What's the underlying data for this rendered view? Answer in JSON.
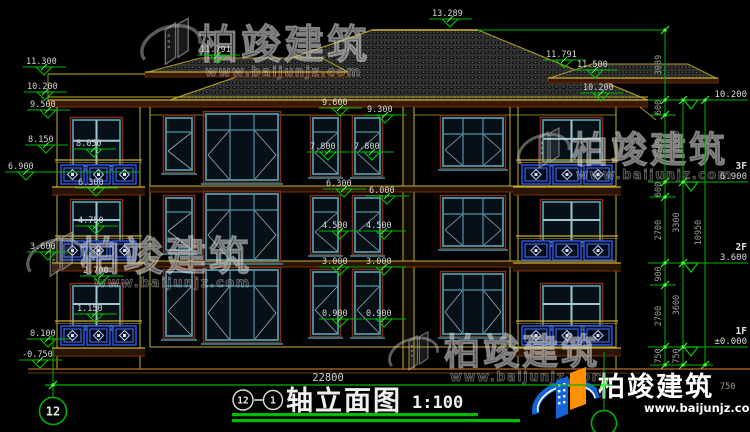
{
  "colors": {
    "dim_green": "#00b400",
    "tick_green": "#3fff3f",
    "marker_text": "#d6d6d6",
    "chain_text": "#93a389",
    "wall_yellow": "#c8b030",
    "fascia_brown": "#3a1a06",
    "fascia_edge": "#7a3010",
    "window_teal": "#4f96aa",
    "railing_blue": "#2a52e0",
    "ground_brown": "#9a5a20",
    "logo_blue": "#1565d8",
    "logo_orange": "#ff9100"
  },
  "watermark": {
    "brand": "柏竣建筑",
    "url": "www.baijunjz.com"
  },
  "title_block": {
    "axis_a": "12",
    "axis_b": "1",
    "dash": "—",
    "title": "轴立面图",
    "scale": "1:100"
  },
  "bottom": {
    "total_width": "22800",
    "axis_bubble": "12",
    "extra_750": "750"
  },
  "floor_levels": [
    {
      "label": "",
      "value": "10.200",
      "y": 100
    },
    {
      "label": "3F",
      "value": "6.900",
      "y": 182
    },
    {
      "label": "2F",
      "value": "3.600",
      "y": 263
    },
    {
      "label": "1F",
      "value": "±0.000",
      "y": 347
    }
  ],
  "dim_chains": [
    {
      "x": 665,
      "segments": [
        {
          "label": "3089",
          "y1": 30,
          "y2": 100
        },
        {
          "label": "600",
          "y1": 100,
          "y2": 115
        },
        {
          "label": "2700",
          "y1": 115,
          "y2": 182
        },
        {
          "label": "600",
          "y1": 182,
          "y2": 197
        },
        {
          "label": "2700",
          "y1": 197,
          "y2": 263
        },
        {
          "label": "900",
          "y1": 263,
          "y2": 285
        },
        {
          "label": "2700",
          "y1": 285,
          "y2": 347
        },
        {
          "label": "750",
          "y1": 347,
          "y2": 365
        }
      ]
    },
    {
      "x": 683,
      "segments": [
        {
          "label": "3300",
          "y1": 100,
          "y2": 182
        },
        {
          "label": "3300",
          "y1": 182,
          "y2": 263
        },
        {
          "label": "3600",
          "y1": 263,
          "y2": 347
        },
        {
          "label": "750",
          "y1": 347,
          "y2": 365
        }
      ]
    },
    {
      "x": 705,
      "segments": [
        {
          "label": "10950",
          "y1": 100,
          "y2": 365
        }
      ]
    }
  ],
  "elevation_markers": [
    {
      "v": "13.289",
      "x": 432,
      "y": 16
    },
    {
      "v": "11.791",
      "x": 200,
      "y": 52
    },
    {
      "v": "11.300",
      "x": 26,
      "y": 64
    },
    {
      "v": "11.791",
      "x": 546,
      "y": 57
    },
    {
      "v": "11.500",
      "x": 577,
      "y": 67
    },
    {
      "v": "10.200",
      "x": 27,
      "y": 89
    },
    {
      "v": "10.200",
      "x": 583,
      "y": 90
    },
    {
      "v": "9.500",
      "x": 30,
      "y": 107
    },
    {
      "v": "9.600",
      "x": 322,
      "y": 105
    },
    {
      "v": "9.300",
      "x": 367,
      "y": 112
    },
    {
      "v": "8.150",
      "x": 28,
      "y": 142
    },
    {
      "v": "8.050",
      "x": 76,
      "y": 146
    },
    {
      "v": "7.800",
      "x": 310,
      "y": 149
    },
    {
      "v": "7.800",
      "x": 354,
      "y": 149
    },
    {
      "v": "6.900",
      "x": 8,
      "y": 169,
      "leader": 140
    },
    {
      "v": "6.300",
      "x": 78,
      "y": 185
    },
    {
      "v": "6.300",
      "x": 326,
      "y": 186
    },
    {
      "v": "6.000",
      "x": 369,
      "y": 193
    },
    {
      "v": "4.750",
      "x": 78,
      "y": 223
    },
    {
      "v": "4.500",
      "x": 322,
      "y": 228
    },
    {
      "v": "4.500",
      "x": 366,
      "y": 228
    },
    {
      "v": "3.600",
      "x": 30,
      "y": 249
    },
    {
      "v": "3.000",
      "x": 322,
      "y": 264
    },
    {
      "v": "3.000",
      "x": 366,
      "y": 264
    },
    {
      "v": "2.700",
      "x": 83,
      "y": 273
    },
    {
      "v": "1.150",
      "x": 77,
      "y": 311
    },
    {
      "v": "0.900",
      "x": 322,
      "y": 316
    },
    {
      "v": "0.900",
      "x": 366,
      "y": 316
    },
    {
      "v": "0.100",
      "x": 30,
      "y": 336
    },
    {
      "v": "-0.750",
      "x": 22,
      "y": 357
    }
  ],
  "watermark_spots": [
    {
      "x": 140,
      "y": 16,
      "scale": 1.15,
      "tx": 198,
      "ty": 58,
      "font": 40,
      "ux": 205,
      "uy": 76
    },
    {
      "x": 517,
      "y": 126,
      "scale": 1.0,
      "tx": 572,
      "ty": 162,
      "font": 36,
      "ux": 576,
      "uy": 179
    },
    {
      "x": 26,
      "y": 230,
      "scale": 1.1,
      "tx": 80,
      "ty": 270,
      "font": 40,
      "ux": 94,
      "uy": 287
    },
    {
      "x": 388,
      "y": 330,
      "scale": 0.95,
      "tx": 444,
      "ty": 364,
      "font": 36,
      "ux": 450,
      "uy": 381
    }
  ]
}
